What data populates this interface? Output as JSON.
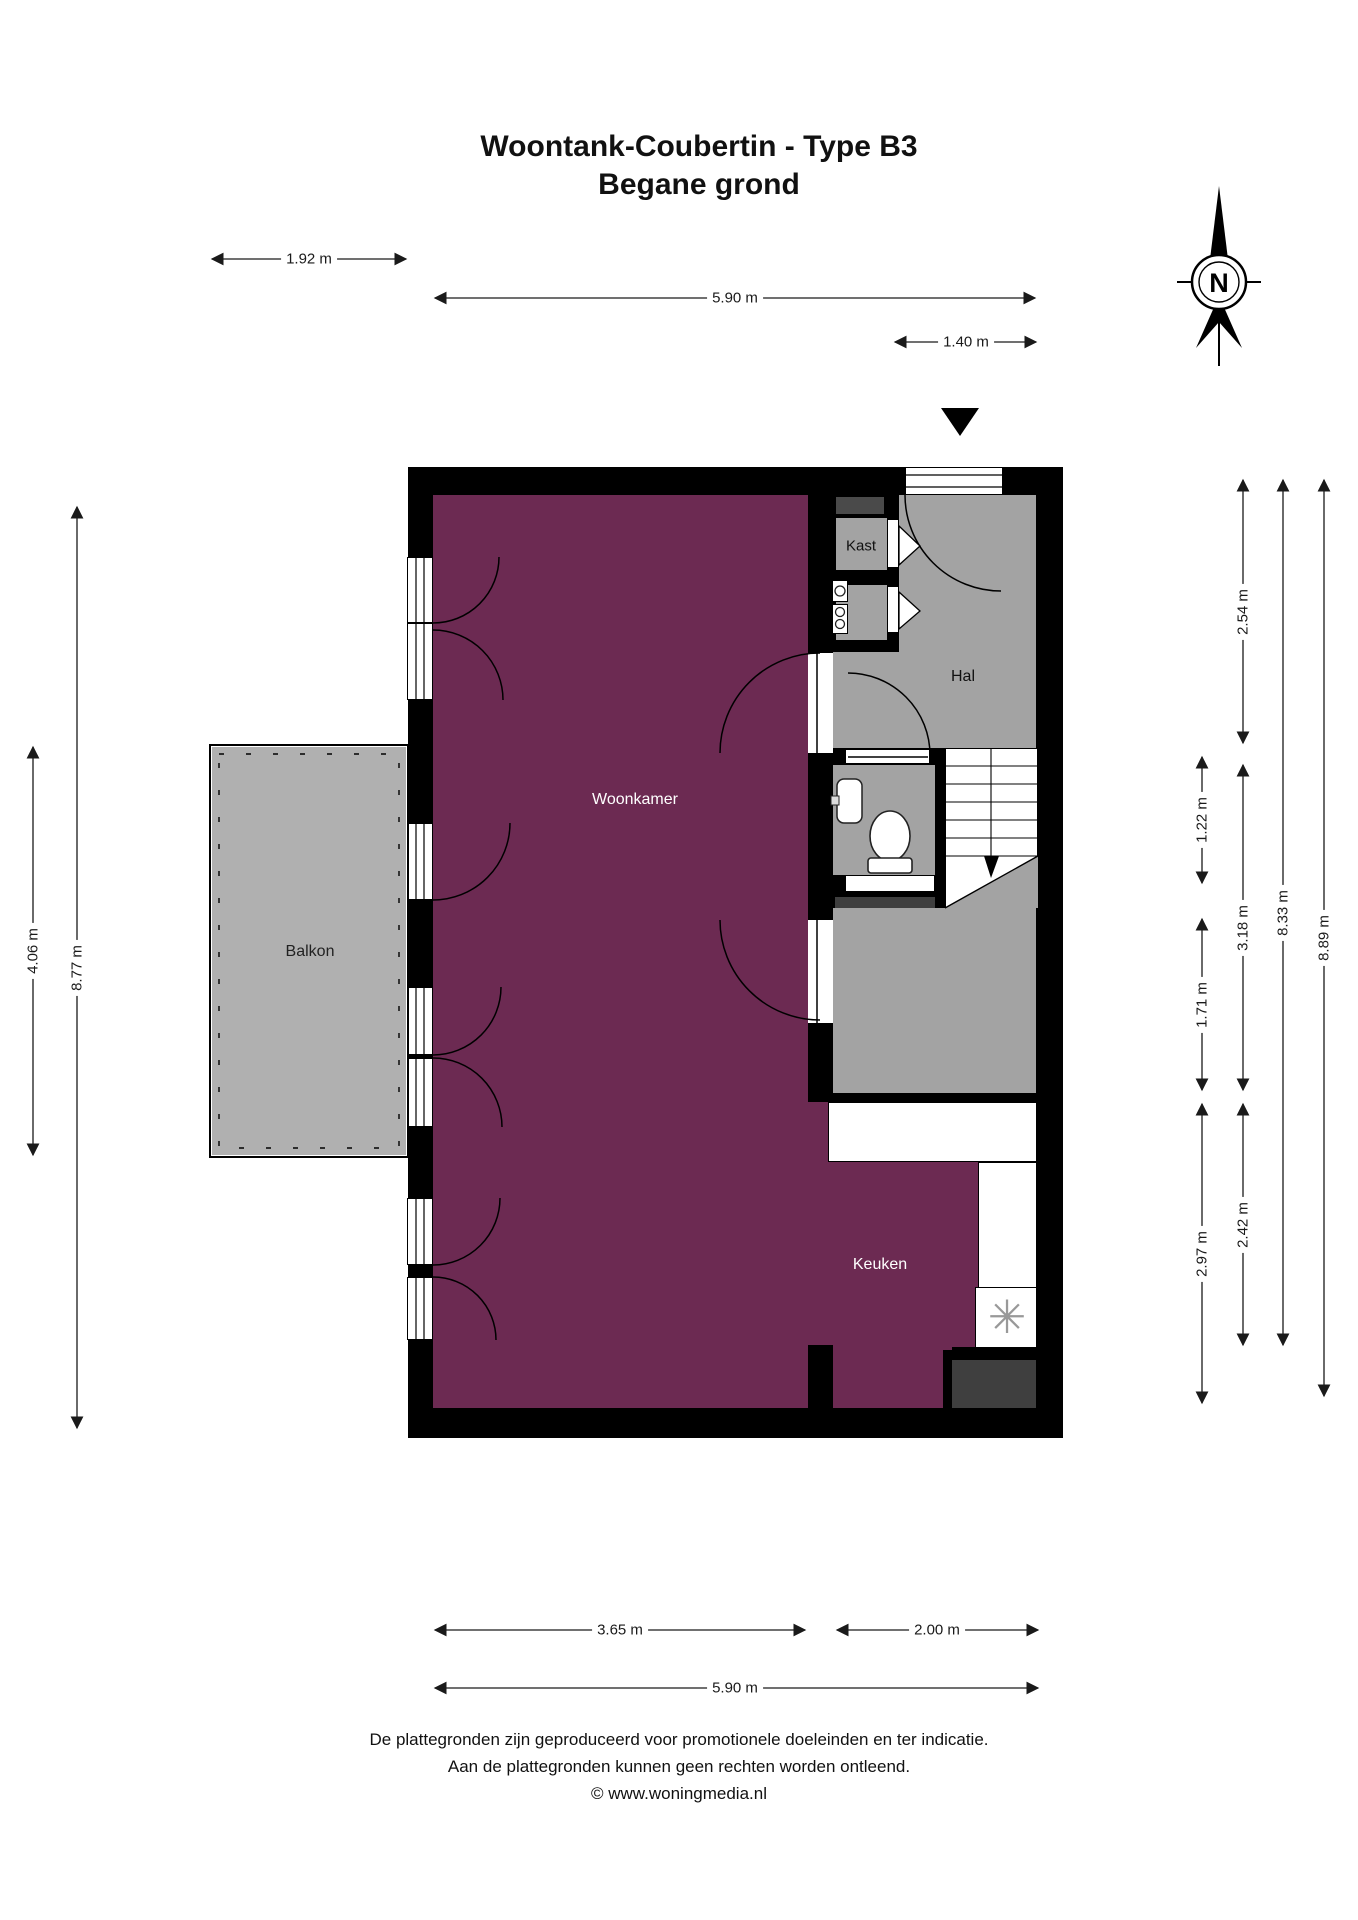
{
  "title": {
    "line1": "Woontank-Coubertin - Type B3",
    "line2": "Begane grond"
  },
  "compass": {
    "letter": "N"
  },
  "rooms": {
    "woonkamer": "Woonkamer",
    "hal": "Hal",
    "kast": "Kast",
    "keuken": "Keuken",
    "balkon": "Balkon"
  },
  "dimensions": {
    "top": [
      {
        "label": "1.92 m"
      },
      {
        "label": "5.90 m"
      },
      {
        "label": "1.40 m"
      }
    ],
    "bottom": [
      {
        "label": "3.65 m"
      },
      {
        "label": "2.00 m"
      },
      {
        "label": "5.90 m"
      }
    ],
    "left": [
      {
        "label": "4.06 m"
      },
      {
        "label": "8.77 m"
      }
    ],
    "right": [
      {
        "label": "1.22 m"
      },
      {
        "label": "1.71 m"
      },
      {
        "label": "2.97 m"
      },
      {
        "label": "2.54 m"
      },
      {
        "label": "3.18 m"
      },
      {
        "label": "2.42 m"
      },
      {
        "label": "8.33 m"
      },
      {
        "label": "8.89 m"
      }
    ]
  },
  "icons": {
    "hob_fan": "✳"
  },
  "footer": {
    "line1": "De plattegronden zijn geproduceerd voor promotionele doeleinden en ter indicatie.",
    "line2": "Aan de plattegronden kunnen geen rechten worden ontleend.",
    "line3": "© www.woningmedia.nl"
  },
  "colors": {
    "room_accent": "#6C2A52",
    "floor_gray": "#A3A3A3",
    "balcony_gray": "#B0B0B0",
    "shaft_dark": "#3F3F3F",
    "meter_shaft": "#4A4A4A",
    "wall": "#000000"
  }
}
